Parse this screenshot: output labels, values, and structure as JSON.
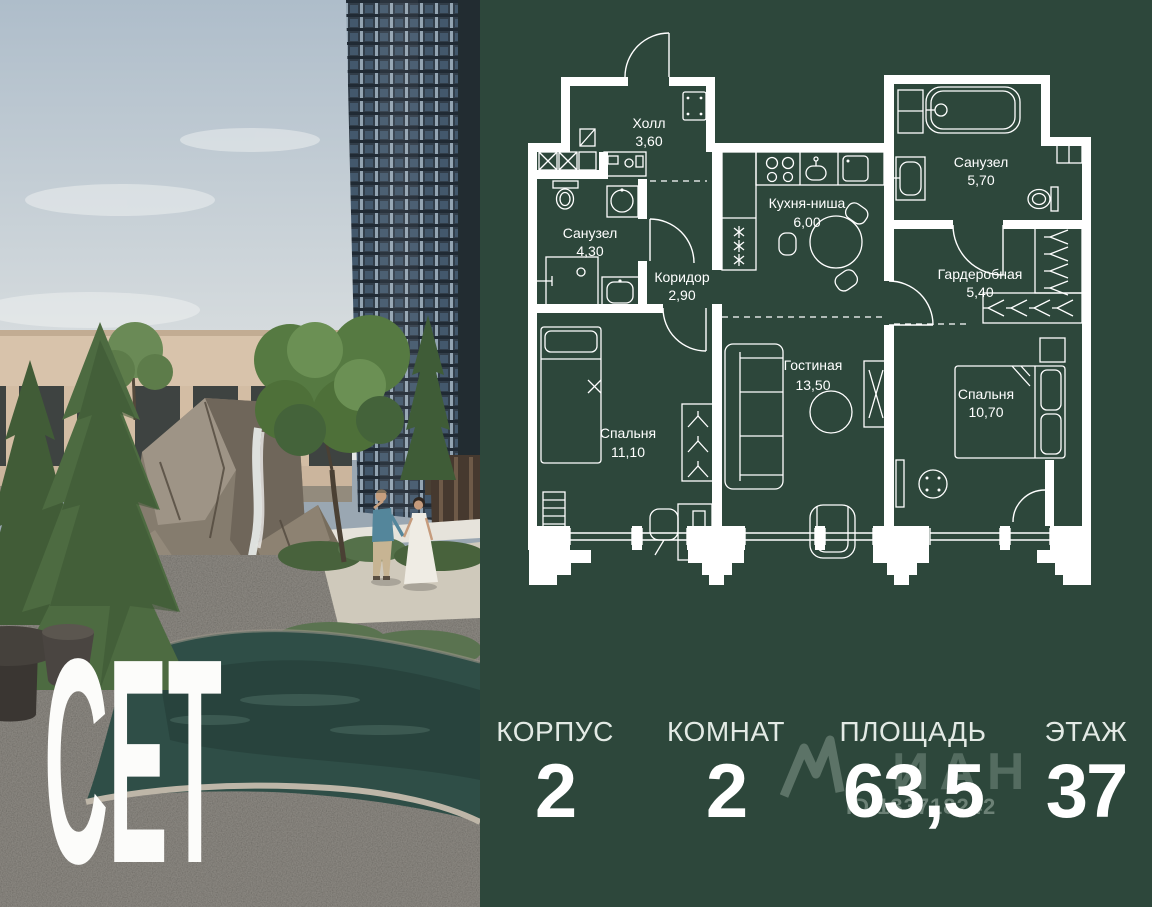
{
  "brand": {
    "logo": "СЕТ"
  },
  "floorplan": {
    "rooms": [
      {
        "name": "Холл",
        "area": "3,60"
      },
      {
        "name": "Санузел",
        "area": "4,30"
      },
      {
        "name": "Коридор",
        "area": "2,90"
      },
      {
        "name": "Кухня-ниша",
        "area": "6,00"
      },
      {
        "name": "Санузел",
        "area": "5,70"
      },
      {
        "name": "Гардеробная",
        "area": "5,40"
      },
      {
        "name": "Гостиная",
        "area": "13,50"
      },
      {
        "name": "Спальня",
        "area": "11,10"
      },
      {
        "name": "Спальня",
        "area": "10,70"
      }
    ]
  },
  "stats": [
    {
      "label": "КОРПУС",
      "value": "2"
    },
    {
      "label": "КОМНАТ",
      "value": "2"
    },
    {
      "label": "ПЛОЩАДЬ",
      "value": "63,5"
    },
    {
      "label": "ЭТАЖ",
      "value": "37"
    }
  ],
  "watermark": {
    "logo_text": "ИАН",
    "id_text": "ID 133718242"
  },
  "colors": {
    "panel_bg": "#2d473b",
    "plan_line": "#ffffff",
    "accent_text": "#ffffff"
  }
}
